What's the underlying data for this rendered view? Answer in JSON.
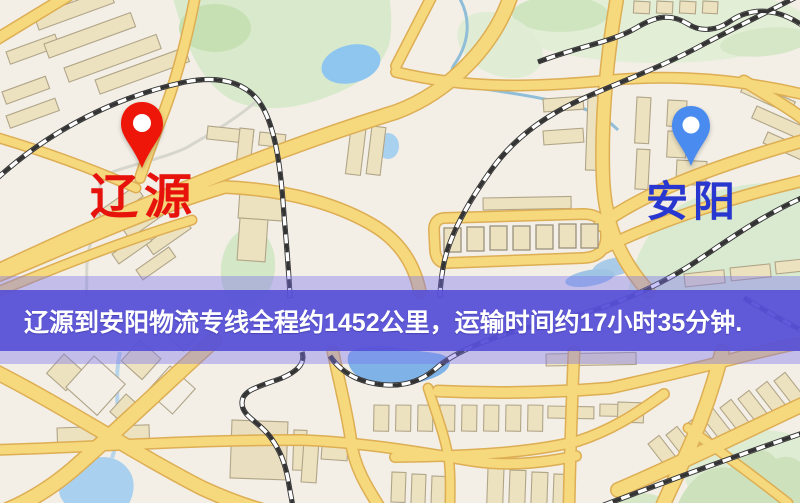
{
  "banner": {
    "text": "辽源到安阳物流专线全程约1452公里，运输时间约17小时35分钟.",
    "background_color": "#554fd7",
    "text_color": "#ffffff"
  },
  "route": {
    "origin_city": "辽源",
    "destination_city": "安阳",
    "distance_km": "1452",
    "duration_hours": "17",
    "duration_minutes": "35"
  },
  "pins": {
    "origin": {
      "label": "辽源",
      "color": "#ee1509",
      "label_color": "#e8120c"
    },
    "destination": {
      "label": "安阳",
      "color": "#4a8bf0",
      "label_color": "#2837cf"
    }
  },
  "map_colors": {
    "background": "#f3efe7",
    "road_fill": "#f6d87d",
    "road_casing": "#ddae54",
    "building_fill": "#ece2c0",
    "building_stroke": "#b1a588",
    "green_area": "#d8e9cc",
    "water": "#8ec6f0",
    "railway": "#333333"
  }
}
